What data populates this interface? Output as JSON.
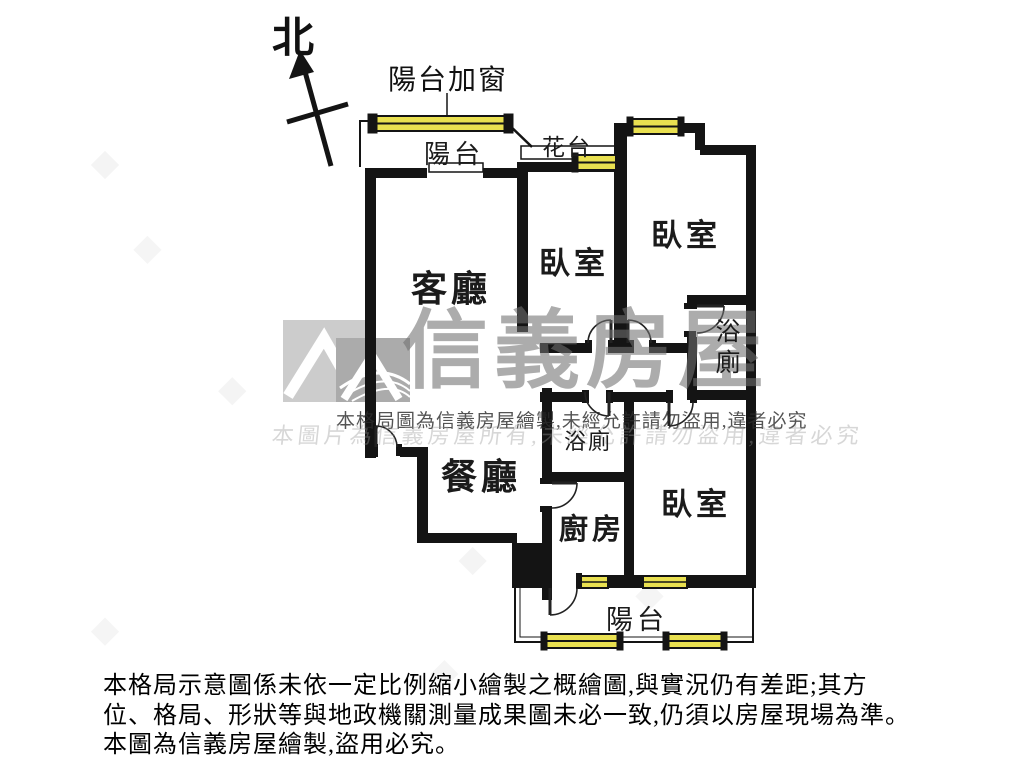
{
  "compass": {
    "north": "北"
  },
  "annotations": {
    "balcony_window": "陽台加窗"
  },
  "rooms": {
    "balcony_top": "陽台",
    "flower_bed": "花台",
    "living_room": "客廳",
    "bedroom_top_middle": "臥室",
    "bedroom_top_right": "臥室",
    "bathroom_right": "浴廁",
    "dining_room": "餐廳",
    "bathroom_middle": "浴廁",
    "kitchen": "廚房",
    "bedroom_bottom_right": "臥室",
    "balcony_bottom": "陽台"
  },
  "watermark": {
    "brand": "信義房屋",
    "notice": "本格局圖為信義房屋繪製,未經允許請勿盜用,違者必究",
    "notice_echo": "本圖片為信義房屋所有,未經允許請勿盜用,違者必究"
  },
  "disclaimer": {
    "line1": "本格局示意圖係未依一定比例縮小繪製之概繪圖,與實況仍有差距;其方",
    "line2": "位、格局、形狀等與地政機關測量成果圖未必一致,仍須以房屋現場為準。",
    "line3": "本圖為信義房屋繪製,盜用必究。"
  },
  "colors": {
    "wall": "#141414",
    "window_yellow": "#e9e050",
    "watermark_gray": "#9a9a9a"
  }
}
